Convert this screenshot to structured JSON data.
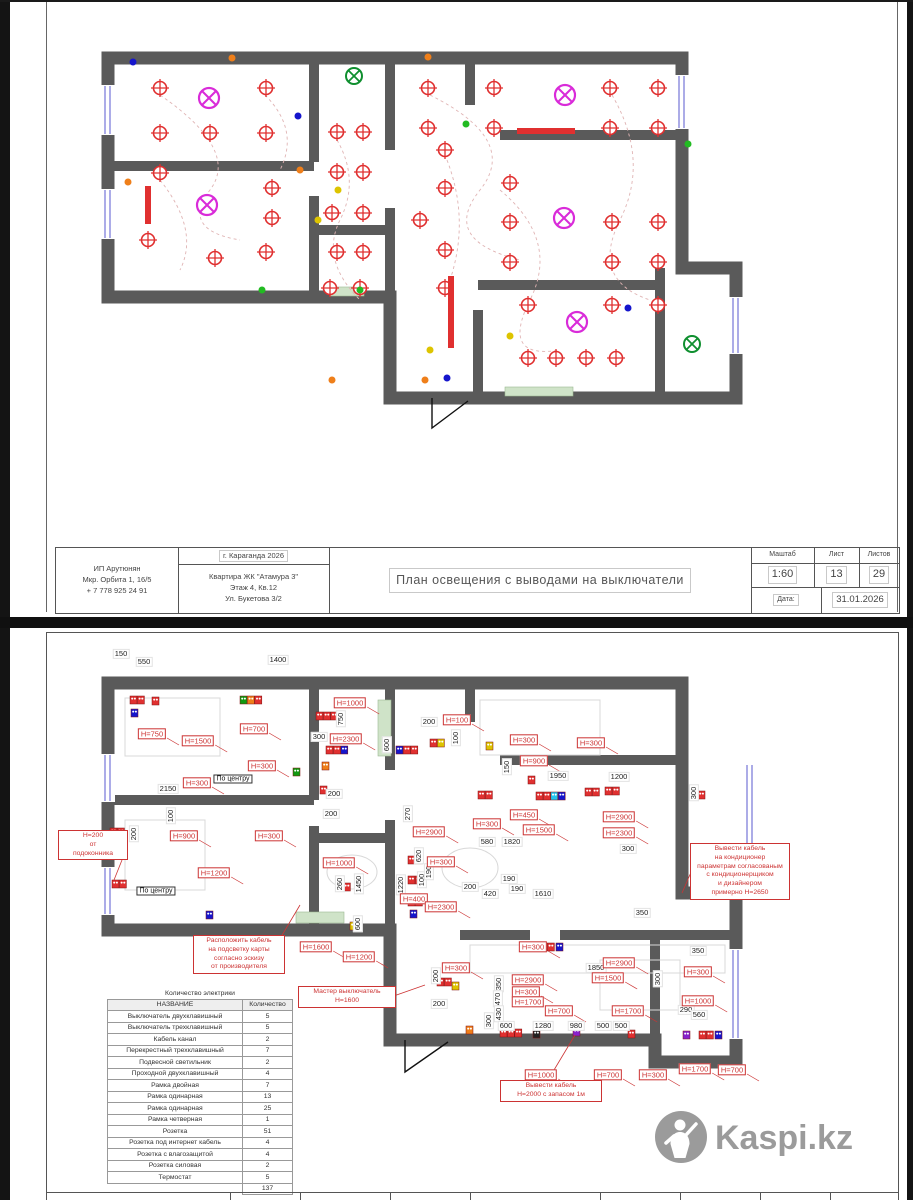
{
  "page1": {
    "stamp": {
      "author_lines": [
        "ИП Арутюнян",
        "Мкр. Орбита 1, 16/5",
        "+ 7 778 925 24 91"
      ],
      "city": "г. Караганда 2026",
      "object_lines": [
        "Квартира ЖК \"Атамура 3\"",
        "Этаж 4, Кв.12",
        "Ул. Букетова 3/2"
      ],
      "title": "План освещения с выводами на выключатели",
      "scale_label": "Маштаб",
      "scale": "1:60",
      "sheet_label": "Лист",
      "sheet": "13",
      "sheets_label": "Листов",
      "sheets": "29",
      "date_label": "Дата:",
      "date": "31.01.2026"
    },
    "walls": {
      "outer": "M108,58 L682,58 L682,268 L736,268 L736,398 L390,398 L390,297 L108,297 Z",
      "inner": [
        "M314,58 V162",
        "M108,166 H314",
        "M314,196 V297",
        "M314,230 H390",
        "M390,58 V150",
        "M390,208 V297",
        "M390,330 V398",
        "M470,58 V105",
        "M500,135 H682",
        "M478,285 H660",
        "M478,310 V398",
        "M660,268 V398"
      ],
      "windows": [
        [
          102,
          86,
          12,
          48
        ],
        [
          102,
          190,
          12,
          48
        ],
        [
          676,
          76,
          12,
          52
        ],
        [
          730,
          298,
          12,
          55
        ]
      ],
      "sills": [
        [
          330,
          287,
          34,
          9
        ],
        [
          505,
          387,
          68,
          9
        ]
      ],
      "door": "M432,398 L432,428 L468,401"
    },
    "lights": {
      "spots": [
        [
          160,
          88
        ],
        [
          266,
          88
        ],
        [
          160,
          133
        ],
        [
          210,
          133
        ],
        [
          266,
          133
        ],
        [
          160,
          173
        ],
        [
          272,
          188
        ],
        [
          272,
          218
        ],
        [
          148,
          240
        ],
        [
          215,
          258
        ],
        [
          266,
          252
        ],
        [
          337,
          132
        ],
        [
          363,
          132
        ],
        [
          337,
          172
        ],
        [
          363,
          172
        ],
        [
          332,
          213
        ],
        [
          363,
          213
        ],
        [
          337,
          252
        ],
        [
          363,
          252
        ],
        [
          330,
          288
        ],
        [
          360,
          288
        ],
        [
          428,
          88
        ],
        [
          494,
          88
        ],
        [
          610,
          88
        ],
        [
          658,
          88
        ],
        [
          428,
          128
        ],
        [
          494,
          128
        ],
        [
          610,
          128
        ],
        [
          658,
          128
        ],
        [
          445,
          150
        ],
        [
          445,
          188
        ],
        [
          510,
          183
        ],
        [
          420,
          220
        ],
        [
          445,
          250
        ],
        [
          510,
          222
        ],
        [
          612,
          222
        ],
        [
          658,
          222
        ],
        [
          510,
          262
        ],
        [
          612,
          262
        ],
        [
          658,
          262
        ],
        [
          445,
          288
        ],
        [
          528,
          305
        ],
        [
          612,
          305
        ],
        [
          658,
          305
        ],
        [
          528,
          358
        ],
        [
          556,
          358
        ],
        [
          586,
          358
        ],
        [
          616,
          358
        ]
      ],
      "chandeliers": [
        [
          209,
          98
        ],
        [
          207,
          205
        ],
        [
          565,
          95
        ],
        [
          564,
          218
        ],
        [
          577,
          322
        ]
      ],
      "greens": [
        [
          354,
          76
        ],
        [
          692,
          344
        ]
      ],
      "bars": [
        [
          517,
          128,
          58,
          6
        ],
        [
          145,
          186,
          6,
          38
        ],
        [
          448,
          276,
          6,
          72
        ]
      ],
      "dots": {
        "o": [
          [
            232,
            58
          ],
          [
            428,
            57
          ],
          [
            300,
            170
          ],
          [
            128,
            182
          ],
          [
            332,
            380
          ],
          [
            425,
            380
          ]
        ],
        "b": [
          [
            133,
            62
          ],
          [
            298,
            116
          ],
          [
            628,
            308
          ],
          [
            447,
            378
          ]
        ],
        "g": [
          [
            262,
            290
          ],
          [
            360,
            290
          ],
          [
            466,
            124
          ],
          [
            688,
            144
          ]
        ],
        "y": [
          [
            318,
            220
          ],
          [
            510,
            336
          ],
          [
            430,
            350
          ],
          [
            338,
            190
          ]
        ]
      },
      "decor": [
        "M160,95 Q240,150 210,190 T240,240",
        "M430,95 Q520,140 480,190 T520,260",
        "M337,140 Q360,180 340,220 T360,300",
        "M612,95 Q650,160 620,220 T650,300",
        "M160,180 Q200,230 180,270",
        "M500,190 Q560,240 530,300 T560,350",
        "M447,160 Q470,220 450,280",
        "M265,95 Q300,130 280,170"
      ]
    }
  },
  "page2": {
    "walls": {
      "outer": "M108,683 L682,683 L682,893 L736,893 L736,1062 L655,1062 L655,1040 L390,1040 L390,930 L108,930 Z",
      "inner": [
        "M314,683 V800",
        "M108,800 H314",
        "M314,826 V930",
        "M314,838 H390",
        "M390,683 V770",
        "M390,820 V930",
        "M390,958 V1040",
        "M470,683 V722",
        "M500,760 H682",
        "M460,935 H530",
        "M560,935 H736",
        "M655,940 V1062"
      ],
      "windows": [
        [
          102,
          755,
          12,
          46
        ],
        [
          102,
          868,
          12,
          46
        ],
        [
          744,
          765,
          10,
          88
        ],
        [
          730,
          950,
          12,
          88
        ]
      ],
      "sills": [
        [
          378,
          700,
          13,
          56
        ],
        [
          296,
          912,
          48,
          11
        ]
      ],
      "door": "M405,1040 L405,1072 L448,1042"
    },
    "furniture": {
      "rects": [
        [
          125,
          698,
          95,
          58
        ],
        [
          125,
          820,
          80,
          70
        ],
        [
          480,
          700,
          120,
          55
        ],
        [
          470,
          945,
          255,
          28
        ],
        [
          600,
          960,
          80,
          50
        ]
      ],
      "ellipses": [
        [
          352,
          872,
          25,
          17
        ],
        [
          470,
          868,
          28,
          20
        ]
      ]
    },
    "outlets": [
      [
        130,
        696,
        "rr"
      ],
      [
        131,
        709,
        "b"
      ],
      [
        152,
        697,
        "r"
      ],
      [
        240,
        696,
        "gor"
      ],
      [
        316,
        712,
        "rrr"
      ],
      [
        326,
        746,
        "rrb"
      ],
      [
        396,
        746,
        "brr"
      ],
      [
        430,
        739,
        "ry"
      ],
      [
        486,
        742,
        "y"
      ],
      [
        528,
        776,
        "r"
      ],
      [
        585,
        788,
        "rr"
      ],
      [
        536,
        792,
        "rrcb"
      ],
      [
        478,
        791,
        "rr"
      ],
      [
        698,
        791,
        "r"
      ],
      [
        408,
        856,
        "rr"
      ],
      [
        408,
        876,
        "rr"
      ],
      [
        408,
        898,
        "rr"
      ],
      [
        410,
        910,
        "b"
      ],
      [
        336,
        883,
        "rr"
      ],
      [
        350,
        922,
        "y"
      ],
      [
        110,
        828,
        "rr"
      ],
      [
        112,
        880,
        "rr"
      ],
      [
        206,
        911,
        "b"
      ],
      [
        293,
        768,
        "g"
      ],
      [
        320,
        786,
        "r"
      ],
      [
        322,
        762,
        "o"
      ],
      [
        540,
        943,
        "rr"
      ],
      [
        556,
        943,
        "b"
      ],
      [
        605,
        787,
        "rr"
      ],
      [
        437,
        978,
        "rr"
      ],
      [
        452,
        982,
        "y"
      ],
      [
        466,
        1026,
        "o"
      ],
      [
        500,
        1029,
        "rrr"
      ],
      [
        533,
        1030,
        "k"
      ],
      [
        573,
        1028,
        "v"
      ],
      [
        628,
        1030,
        "r"
      ],
      [
        683,
        1031,
        "v"
      ],
      [
        699,
        1031,
        "rr"
      ],
      [
        715,
        1031,
        "b"
      ]
    ],
    "dims": [
      [
        "150",
        121,
        654
      ],
      [
        "550",
        144,
        662
      ],
      [
        "1400",
        278,
        660
      ],
      [
        "2150",
        168,
        789
      ],
      [
        "300",
        319,
        737
      ],
      [
        "750",
        341,
        719,
        1
      ],
      [
        "600",
        387,
        745,
        1
      ],
      [
        "200",
        429,
        722
      ],
      [
        "100",
        456,
        738,
        1
      ],
      [
        "150",
        507,
        767,
        1
      ],
      [
        "1950",
        558,
        776
      ],
      [
        "1200",
        619,
        777
      ],
      [
        "300",
        694,
        793,
        1
      ],
      [
        "270",
        408,
        814,
        1
      ],
      [
        "620",
        419,
        856,
        1
      ],
      [
        "1220",
        401,
        885,
        1
      ],
      [
        "100",
        422,
        880,
        1
      ],
      [
        "190",
        429,
        872,
        1
      ],
      [
        "200",
        470,
        887
      ],
      [
        "420",
        490,
        894
      ],
      [
        "190",
        509,
        879
      ],
      [
        "190",
        517,
        889
      ],
      [
        "1610",
        543,
        894
      ],
      [
        "580",
        487,
        842
      ],
      [
        "1820",
        512,
        842
      ],
      [
        "300",
        628,
        849
      ],
      [
        "350",
        642,
        913
      ],
      [
        "1850",
        596,
        968
      ],
      [
        "300",
        658,
        979,
        1
      ],
      [
        "350",
        698,
        951
      ],
      [
        "200",
        436,
        976,
        1
      ],
      [
        "200",
        439,
        1004
      ],
      [
        "350",
        499,
        984,
        1
      ],
      [
        "470",
        498,
        999,
        1
      ],
      [
        "430",
        499,
        1014,
        1
      ],
      [
        "300",
        489,
        1021,
        1
      ],
      [
        "600",
        506,
        1026
      ],
      [
        "1280",
        543,
        1026
      ],
      [
        "980",
        576,
        1026
      ],
      [
        "500",
        603,
        1026
      ],
      [
        "500",
        621,
        1026
      ],
      [
        "290",
        686,
        1010
      ],
      [
        "560",
        699,
        1015
      ],
      [
        "100",
        171,
        816,
        1
      ],
      [
        "200",
        134,
        834,
        1
      ],
      [
        "260",
        340,
        884,
        1
      ],
      [
        "1450",
        359,
        884,
        1
      ],
      [
        "600",
        358,
        924,
        1
      ],
      [
        "200",
        331,
        814
      ],
      [
        "200",
        334,
        794
      ]
    ],
    "h_labels": [
      [
        "Н=750",
        152,
        734
      ],
      [
        "Н=1500",
        198,
        741
      ],
      [
        "Н=700",
        254,
        729
      ],
      [
        "Н=300",
        197,
        783
      ],
      [
        "Н=300",
        262,
        766
      ],
      [
        "Н=1000",
        350,
        703
      ],
      [
        "Н=2300",
        346,
        739
      ],
      [
        "Н=100",
        457,
        720
      ],
      [
        "Н=300",
        524,
        740
      ],
      [
        "Н=900",
        534,
        761
      ],
      [
        "Н=300",
        591,
        743
      ],
      [
        "Н=450",
        524,
        815
      ],
      [
        "Н=300",
        487,
        824
      ],
      [
        "Н=1500",
        539,
        830
      ],
      [
        "Н=2900",
        619,
        817
      ],
      [
        "Н=2300",
        619,
        833
      ],
      [
        "Н=2900",
        429,
        832
      ],
      [
        "Н=300",
        441,
        862
      ],
      [
        "Н=400",
        414,
        899
      ],
      [
        "Н=2300",
        441,
        907
      ],
      [
        "Н=900",
        184,
        836
      ],
      [
        "Н=300",
        269,
        836
      ],
      [
        "Н=1200",
        214,
        873
      ],
      [
        "Н=1000",
        339,
        863
      ],
      [
        "Н=1600",
        316,
        947
      ],
      [
        "Н=1200",
        359,
        957
      ],
      [
        "Н=300",
        456,
        968
      ],
      [
        "Н=2900",
        528,
        980
      ],
      [
        "Н=300",
        526,
        992
      ],
      [
        "Н=1700",
        528,
        1002
      ],
      [
        "Н=700",
        559,
        1011
      ],
      [
        "Н=1700",
        628,
        1011
      ],
      [
        "Н=300",
        533,
        947
      ],
      [
        "Н=2900",
        619,
        963
      ],
      [
        "Н=1500",
        608,
        978
      ],
      [
        "Н=1000",
        541,
        1075
      ],
      [
        "Н=700",
        608,
        1075
      ],
      [
        "Н=300",
        653,
        1075
      ],
      [
        "Н=300",
        698,
        972
      ],
      [
        "Н=1000",
        698,
        1001
      ],
      [
        "Н=1700",
        695,
        1069
      ],
      [
        "Н=700",
        732,
        1070
      ]
    ],
    "center_labels": [
      [
        "По центру",
        233,
        779
      ],
      [
        "По центру",
        156,
        891
      ]
    ],
    "notes": [
      {
        "x": 58,
        "y": 830,
        "w": 64,
        "lines": [
          "Н=200",
          "от",
          "подоконника"
        ]
      },
      {
        "x": 193,
        "y": 935,
        "w": 86,
        "lines": [
          "Расположить кабель",
          "на подсветку карты",
          "согласно эскизу",
          "от производителя"
        ]
      },
      {
        "x": 298,
        "y": 986,
        "w": 92,
        "lines": [
          "Мастер выключатель",
          "Н=1600"
        ]
      },
      {
        "x": 690,
        "y": 843,
        "w": 94,
        "lines": [
          "Вывести кабель",
          "на кондиционер",
          "параметрам согласованым",
          "с кондиционерщиком",
          "и дизайнером",
          "примерно Н=2650"
        ]
      },
      {
        "x": 500,
        "y": 1080,
        "w": 96,
        "lines": [
          "Вывести кабель",
          "Н=2000 с запасом 1м"
        ]
      }
    ],
    "note_leaders": [
      [
        122,
        845,
        112,
        833
      ],
      [
        122,
        860,
        114,
        880
      ],
      [
        278,
        942,
        300,
        905
      ],
      [
        388,
        998,
        425,
        985
      ],
      [
        692,
        870,
        682,
        893
      ],
      [
        548,
        1080,
        575,
        1035
      ]
    ],
    "table": {
      "title": "Количество электрики",
      "headers": [
        "НАЗВАНИЕ",
        "Количество"
      ],
      "rows": [
        [
          "Выключатель двухклавишный",
          "5"
        ],
        [
          "Выключатель трехклавишный",
          "5"
        ],
        [
          "Кабель канал",
          "2"
        ],
        [
          "Перекрестный трехклавишный",
          "7"
        ],
        [
          "Подвесной светильник",
          "2"
        ],
        [
          "Проходной двухклавишный",
          "4"
        ],
        [
          "Рамка двойная",
          "7"
        ],
        [
          "Рамка одинарная",
          "13"
        ],
        [
          "Рамка одинарная",
          "25"
        ],
        [
          "Рамка четверная",
          "1"
        ],
        [
          "Розетка",
          "51"
        ],
        [
          "Розетка под интернет кабель",
          "4"
        ],
        [
          "Розетка с влагозащитой",
          "4"
        ],
        [
          "Розетка силовая",
          "2"
        ],
        [
          "Термостат",
          "5"
        ]
      ],
      "total": "137"
    },
    "watermark": "Kaspi.kz"
  },
  "colors": {
    "wall": "#5a5a5a",
    "red": "#e03030",
    "label_red": "#cc3333",
    "magenta": "#d92bd9",
    "green": "#0f8f2f",
    "blue": "#1515cc",
    "orange": "#ef7f1a",
    "yellow": "#ddc400",
    "violet": "#8822cc",
    "cyan": "#22c4ee",
    "window_blue": "#8888dd",
    "sill_green": "#cfe3c8",
    "watermark_gray": "#9b9b9b"
  }
}
